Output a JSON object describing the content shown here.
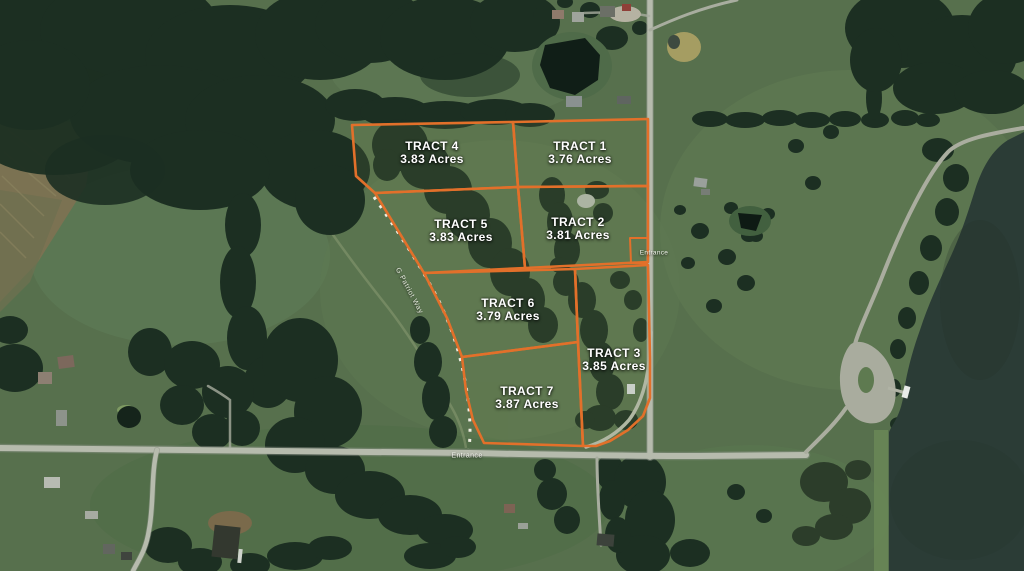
{
  "map": {
    "type": "satellite-plat-map",
    "street_label": "G Patriot Way",
    "entrance_right": "Entrance",
    "entrance_bottom": "Entrance",
    "tracts": [
      {
        "id": 1,
        "name": "TRACT 1",
        "acres": "3.76 Acres"
      },
      {
        "id": 2,
        "name": "TRACT 2",
        "acres": "3.81 Acres"
      },
      {
        "id": 3,
        "name": "TRACT 3",
        "acres": "3.85 Acres"
      },
      {
        "id": 4,
        "name": "TRACT 4",
        "acres": "3.83 Acres"
      },
      {
        "id": 5,
        "name": "TRACT 5",
        "acres": "3.83 Acres"
      },
      {
        "id": 6,
        "name": "TRACT 6",
        "acres": "3.79 Acres"
      },
      {
        "id": 7,
        "name": "TRACT 7",
        "acres": "3.87 Acres"
      }
    ],
    "colors": {
      "boundary_orange": "#e2702a",
      "field_green": "#57704d",
      "forest_green": "#1c2f22",
      "water_dark": "#2b3c36",
      "road_gray": "#b6bbad",
      "label_white": "#ffffff"
    }
  }
}
